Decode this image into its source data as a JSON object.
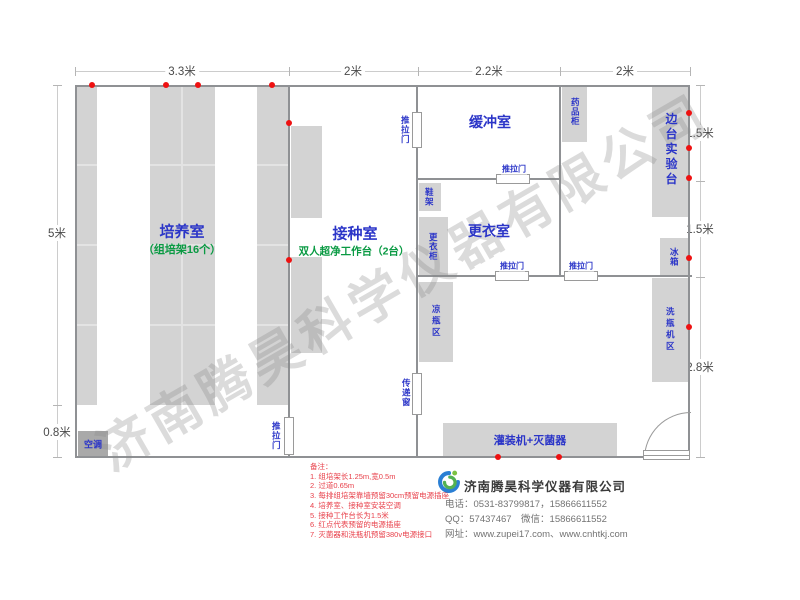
{
  "dims": {
    "top": [
      "3.3米",
      "2米",
      "2.2米",
      "2米"
    ],
    "left": [
      "5米",
      "0.8米"
    ],
    "right": [
      "1.5米",
      "1.5米",
      "2.8米"
    ]
  },
  "rooms": {
    "cultivation": "培养室",
    "cultivation_sub": "（组培架16个）",
    "inoculation": "接种室",
    "inoculation_sub": "双人超净工作台（2台）",
    "buffer": "缓冲室",
    "changing": "更衣室"
  },
  "labels": {
    "ac": "空调",
    "sliding_door": "推拉门",
    "transfer_window": "传递窗",
    "shoe_rack": "鞋架",
    "wardrobe": "更衣柜",
    "cooling_area": "凉瓶区",
    "medicine_cabinet": "药品柜",
    "side_bench": "边台实验台",
    "fridge": "冰箱",
    "washer_area": "洗瓶机区",
    "filling_machine": "灌装机+灭菌器"
  },
  "notes": {
    "title": "备注：",
    "items": [
      "1. 组培架长1.25m,宽0.5m",
      "2. 过道0.65m",
      "3. 每排组培架靠墙预留30cm预留电源插座",
      "4. 培养室、接种室安装空调",
      "5. 接种工作台长为1.5米",
      "6. 红点代表预留的电源插座",
      "7. 灭菌器和洗瓶机预留380v电源接口"
    ]
  },
  "company": {
    "name": "济南腾昊科学仪器有限公司",
    "phone": "电话：0531-83799817，15866611552",
    "qq": "QQ：57437467　微信：15866611552",
    "web": "网址：www.zupei17.com、www.cnhtkj.com"
  },
  "watermark": "济南腾昊科学仪器有限公司",
  "colors": {
    "room_label_blue": "#2b35c8",
    "sub_label_green": "#0a9a43",
    "note_red": "#e8414b",
    "socket_dot_red": "#ee1111",
    "block_gray": "#d3d3d3",
    "wall_gray": "#8f9194"
  }
}
